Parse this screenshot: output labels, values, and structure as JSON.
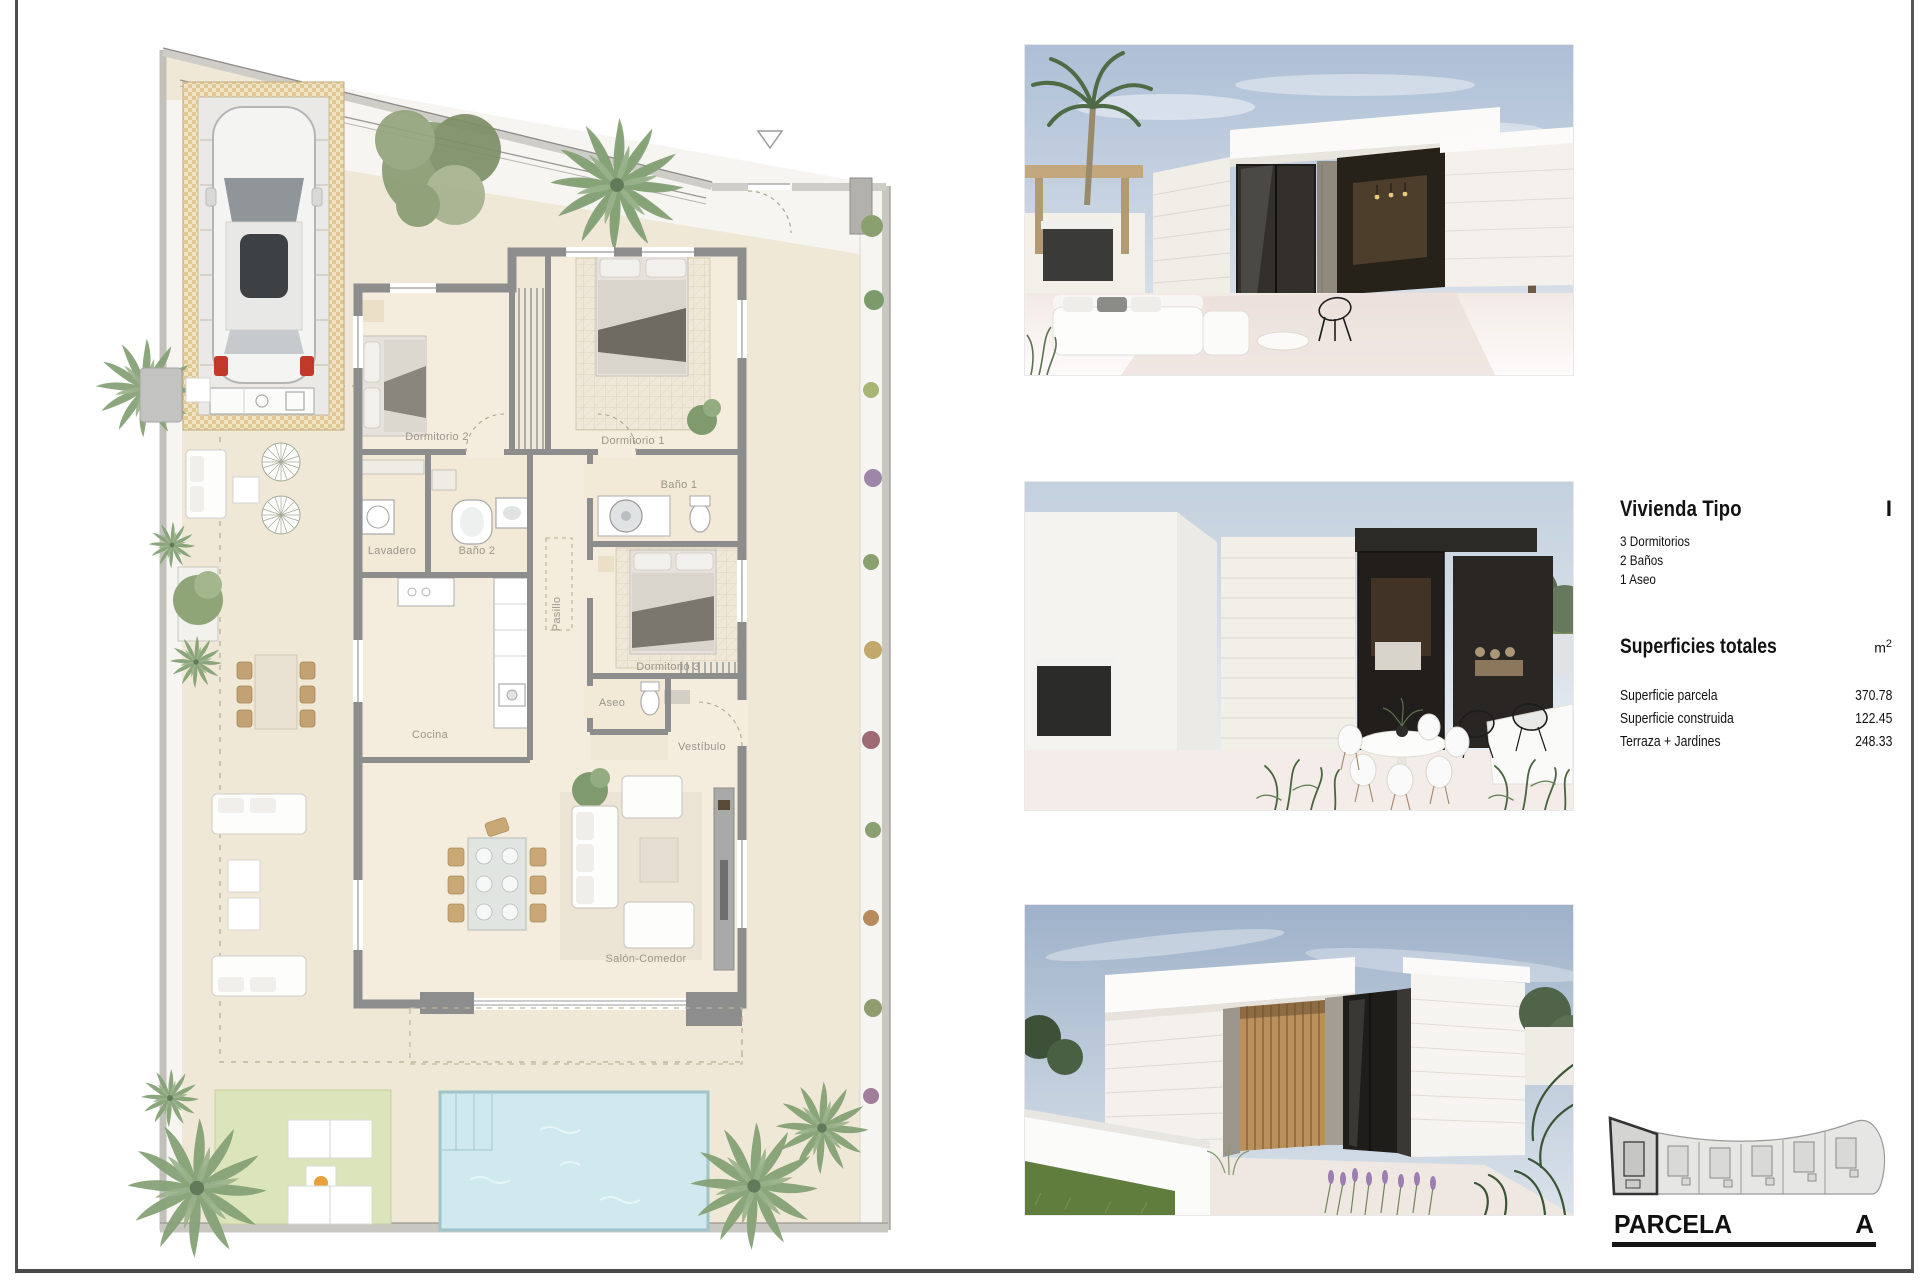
{
  "floorplan": {
    "rooms": [
      {
        "label": "Dormitorio 2"
      },
      {
        "label": "Dormitorio 1"
      },
      {
        "label": "Baño 1"
      },
      {
        "label": "Lavadero"
      },
      {
        "label": "Baño 2"
      },
      {
        "label": "Pasillo"
      },
      {
        "label": "Dormitorio 3"
      },
      {
        "label": "Aseo"
      },
      {
        "label": "Cocina"
      },
      {
        "label": "Vestíbulo"
      },
      {
        "label": "Salón-Comedor"
      }
    ],
    "colors": {
      "ground": "#f0e8d6",
      "room_floor": "#f4eddd",
      "wall": "#8d8d8d",
      "gravel": "#f6f5f1",
      "lawn": "#dbe4ba",
      "pool": "#cfe9ee",
      "garage_frame": "#e0cda2",
      "label_text": "#9c968a"
    }
  },
  "info_panel": {
    "title": "Vivienda Tipo",
    "type_letter": "I",
    "features": [
      "3 Dormitorios",
      "2 Baños",
      "1 Aseo"
    ],
    "surfaces_title": "Superficies totales",
    "unit": "m",
    "unit_sup": "2",
    "surfaces": [
      {
        "label": "Superficie parcela",
        "value": "370.78"
      },
      {
        "label": "Superficie construida",
        "value": "122.45"
      },
      {
        "label": "Terraza + Jardines",
        "value": "248.33"
      }
    ]
  },
  "parcela": {
    "label": "PARCELA",
    "selected_lot": "A",
    "lot_count": 6
  },
  "render_photos": [
    {
      "name": "villa-exterior-terrace-view"
    },
    {
      "name": "villa-terrace-dining-view"
    },
    {
      "name": "villa-corner-wood-slats-view"
    }
  ]
}
